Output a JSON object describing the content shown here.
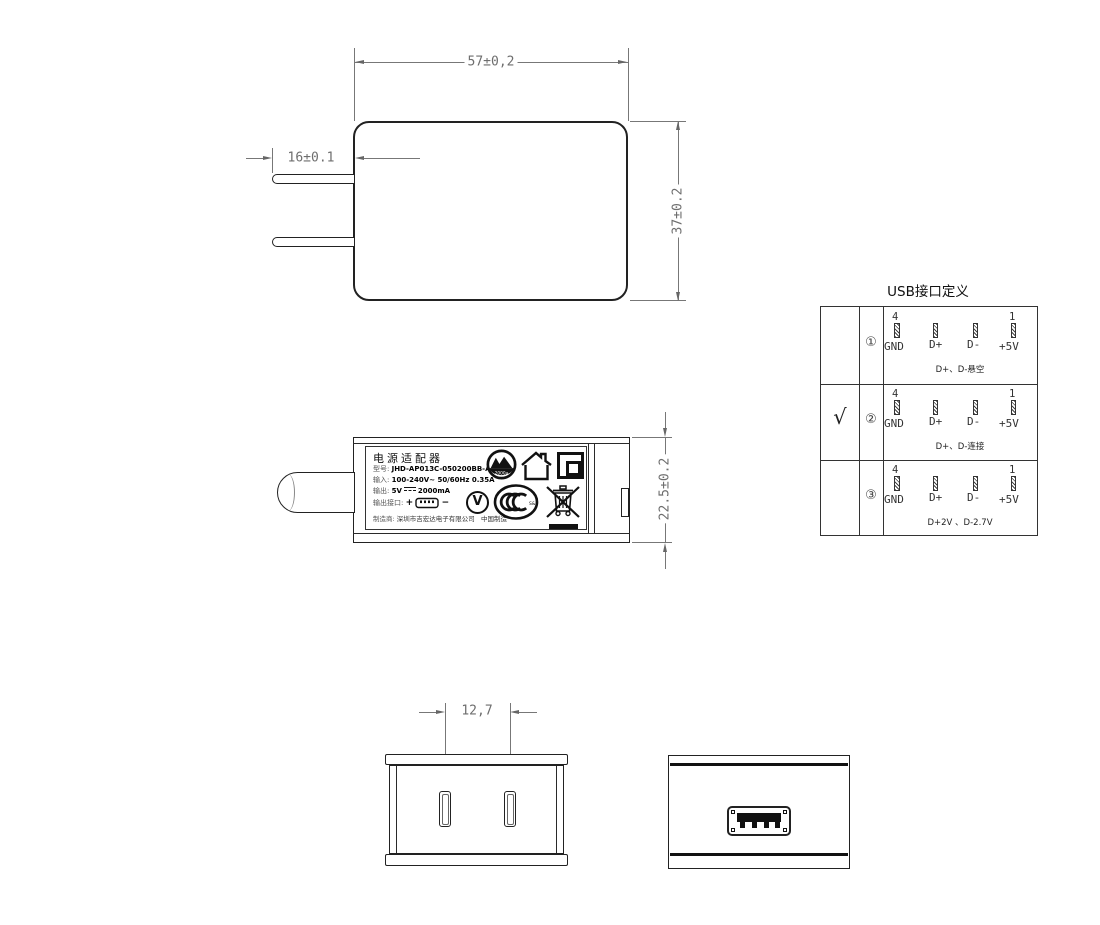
{
  "drawing": {
    "front_view": {
      "dim_width": "57±0,2",
      "dim_prong_length": "16±0.1",
      "dim_height": "37±0.2"
    },
    "side_view": {
      "dim_depth": "22.5±0.2"
    },
    "bottom_view": {
      "dim_prong_spacing": "12,7"
    },
    "label": {
      "title": "电源适配器",
      "model_key": "型号:",
      "model_value": "JHD-AP013C-050200BB-A",
      "input_key": "输入:",
      "input_value": "100-240V~  50/60Hz  0.35A",
      "output_key": "输出:",
      "output_voltage": "5V",
      "output_current": "2000mA",
      "port_key": "输出接口:",
      "port_plus": "+",
      "port_minus": "−",
      "maker_key": "制造商:",
      "maker_value": "深圳市吉宏达电子有限公司",
      "made_in": "中国制造",
      "efficiency_circle_text": "2000a",
      "v_mark_text": "V",
      "ccc_small_text": "S&E"
    },
    "usb_table": {
      "title": "USB接口定义",
      "pin_number_left": "4",
      "pin_number_right": "1",
      "pin_labels": [
        "GND",
        "D+",
        "D-",
        "+5V"
      ],
      "rows": [
        {
          "selected": "",
          "index": "①",
          "note": "D+、D-悬空"
        },
        {
          "selected": "√",
          "index": "②",
          "note": "D+、D-连接"
        },
        {
          "selected": "",
          "index": "③",
          "note": "D+2V 、D-2.7V"
        }
      ]
    }
  }
}
